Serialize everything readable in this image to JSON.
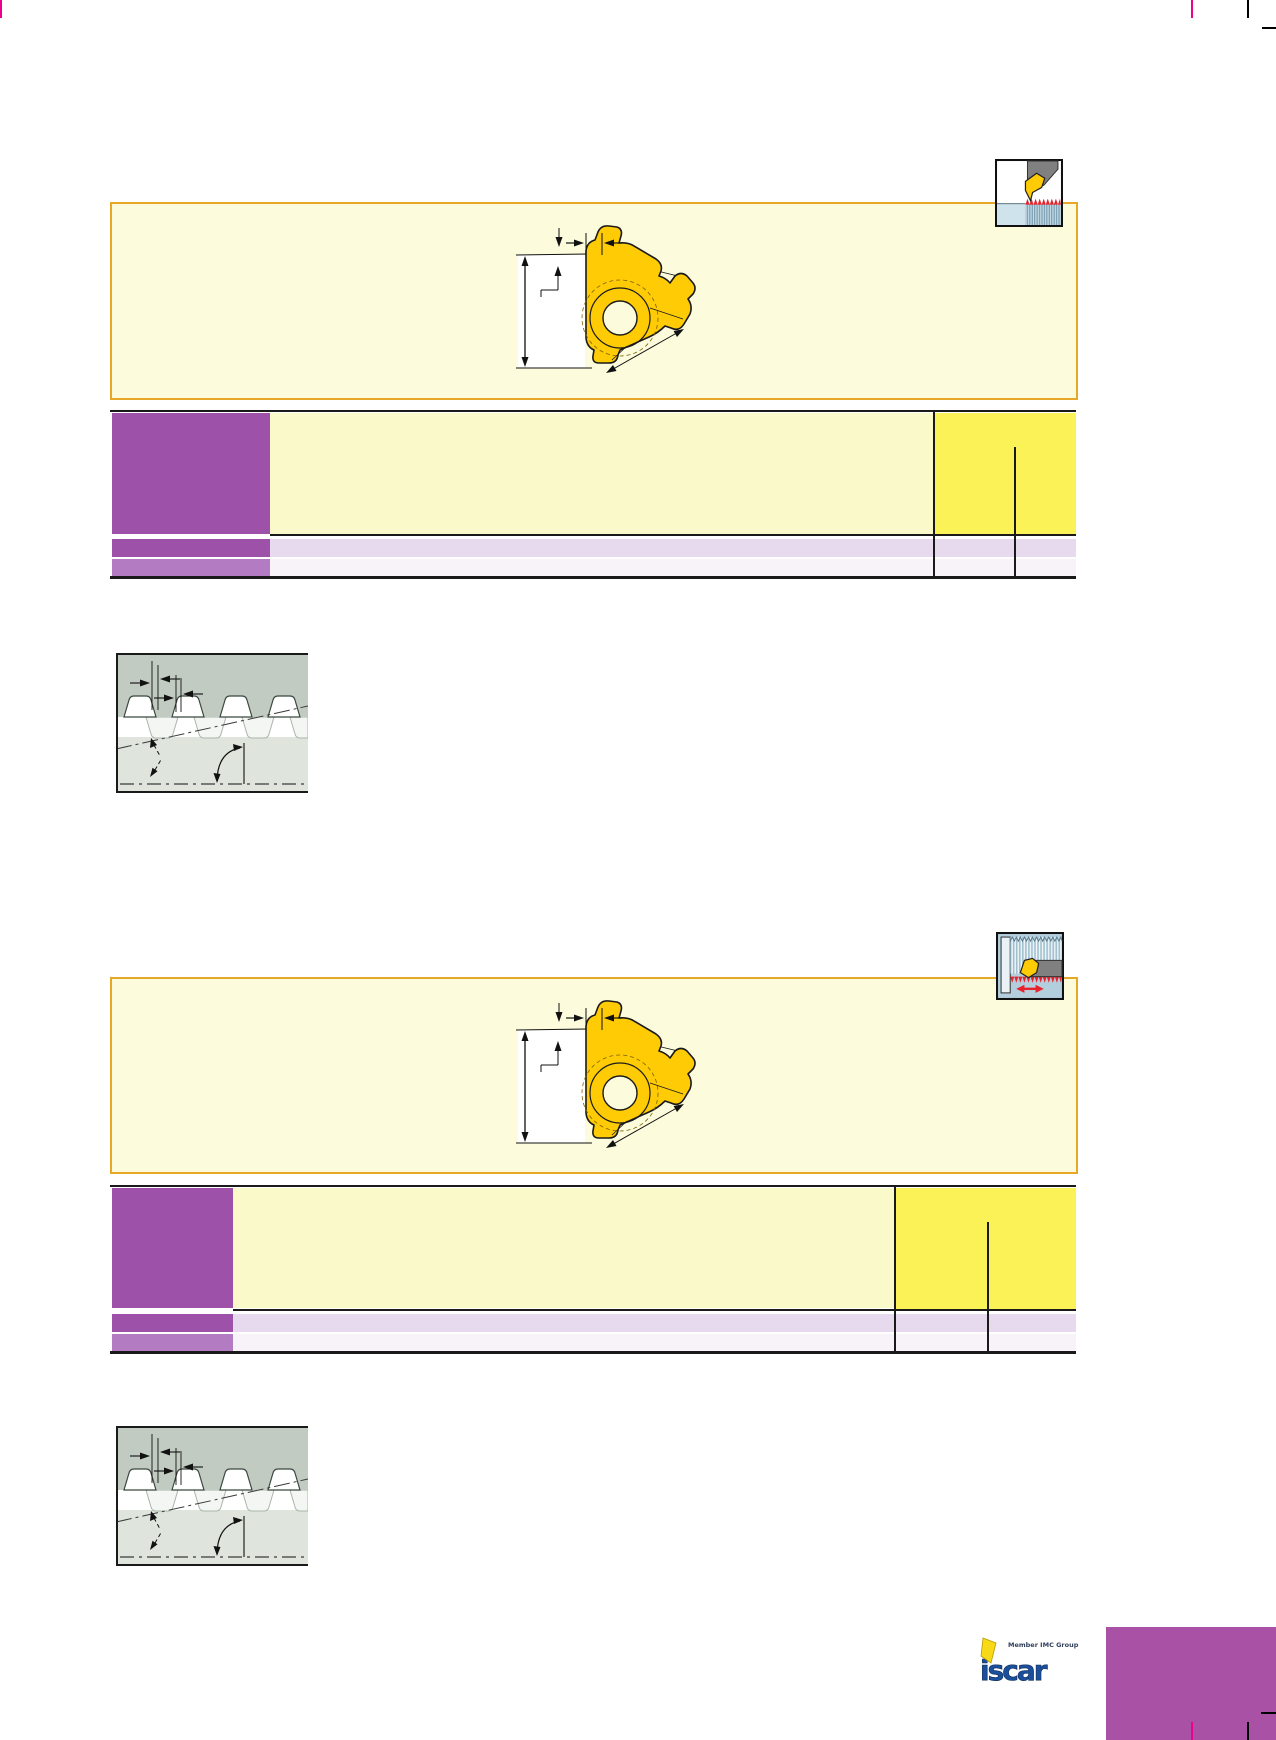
{
  "page": {
    "width": 1276,
    "height": 1740,
    "background": "#ffffff"
  },
  "logo": {
    "text": "iscar",
    "tagline": "Member IMC Group"
  },
  "icons": [
    {
      "name": "external-threading-operation-icon",
      "position": "top-right-of-first-panel"
    },
    {
      "name": "internal-threading-operation-icon",
      "position": "top-right-of-second-panel"
    }
  ],
  "colors": {
    "panel_border_orange": "#E8A827",
    "panel_cream": "#FCFBDC",
    "table_header_purple": "#9D51A9",
    "table_row_purple_light": "#B37BC2",
    "table_cream": "#FAF9C9",
    "table_bright_yellow": "#FBF257",
    "table_row_lavender": "#E7D9EE",
    "table_row_pale": "#F8F3F9",
    "table_rule_black": "#1a1a1a",
    "crop_mark_magenta": "#EC008C",
    "corner_block_magenta": "#A851A5",
    "diagram_gray_dark": "#C2CBC2",
    "diagram_gray_light": "#DFE4DD",
    "insert_yellow": "#FFCB05",
    "icon_red": "#E8212B",
    "icon_workpiece_blue": "#CFE3EC",
    "icon_bore_blue": "#B3CEDC",
    "icon_tool_gray": "#808080",
    "logo_blue": "#1B4E9B",
    "logo_yellow": "#F7D917"
  }
}
